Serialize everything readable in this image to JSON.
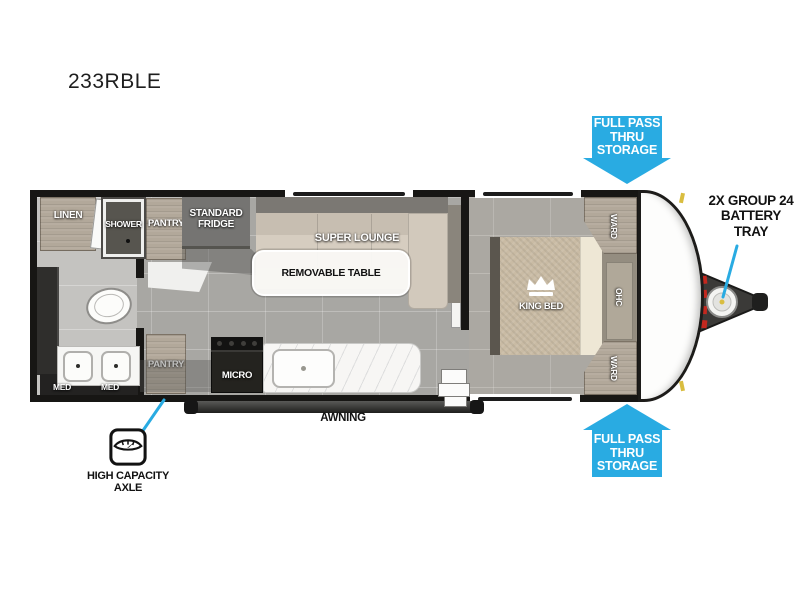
{
  "title": "233RBLE",
  "colors": {
    "accent_blue": "#29ABE2",
    "wall_black": "#171614",
    "floor_gray": "#a8a7a3",
    "cabinet_wood": "#b2a89a",
    "sofa_beige": "#d6cdc0",
    "bed_tan": "#c9bba4",
    "fridge_gray": "#757472",
    "battery_red_marks": "#c3281f",
    "clearance_light_yellow": "#d9bd3f"
  },
  "callouts": {
    "storage_top": "FULL PASS\nTHRU\nSTORAGE",
    "storage_bottom": "FULL PASS\nTHRU\nSTORAGE",
    "battery": "2X GROUP 24\nBATTERY\nTRAY",
    "axle": "HIGH CAPACITY\nAXLE"
  },
  "rooms": {
    "linen": "LINEN",
    "shower": "SHOWER",
    "pantry_top": "PANTRY",
    "pantry_bottom": "PANTRY",
    "fridge": "STANDARD\nFRIDGE",
    "super_lounge": "SUPER LOUNGE",
    "removable_table": "REMOVABLE TABLE",
    "micro": "MICRO",
    "med_left": "MED",
    "med_right": "MED",
    "king_bed": "KING BED",
    "ward_top": "WARD",
    "ward_bottom": "WARD",
    "ohc": "OHC",
    "awning": "AWNING"
  },
  "icons": {
    "crown": "crown-icon",
    "scale": "scale-icon",
    "arrow_down": "arrow-down-icon",
    "arrow_up": "arrow-up-icon",
    "battery": "battery-icon"
  }
}
